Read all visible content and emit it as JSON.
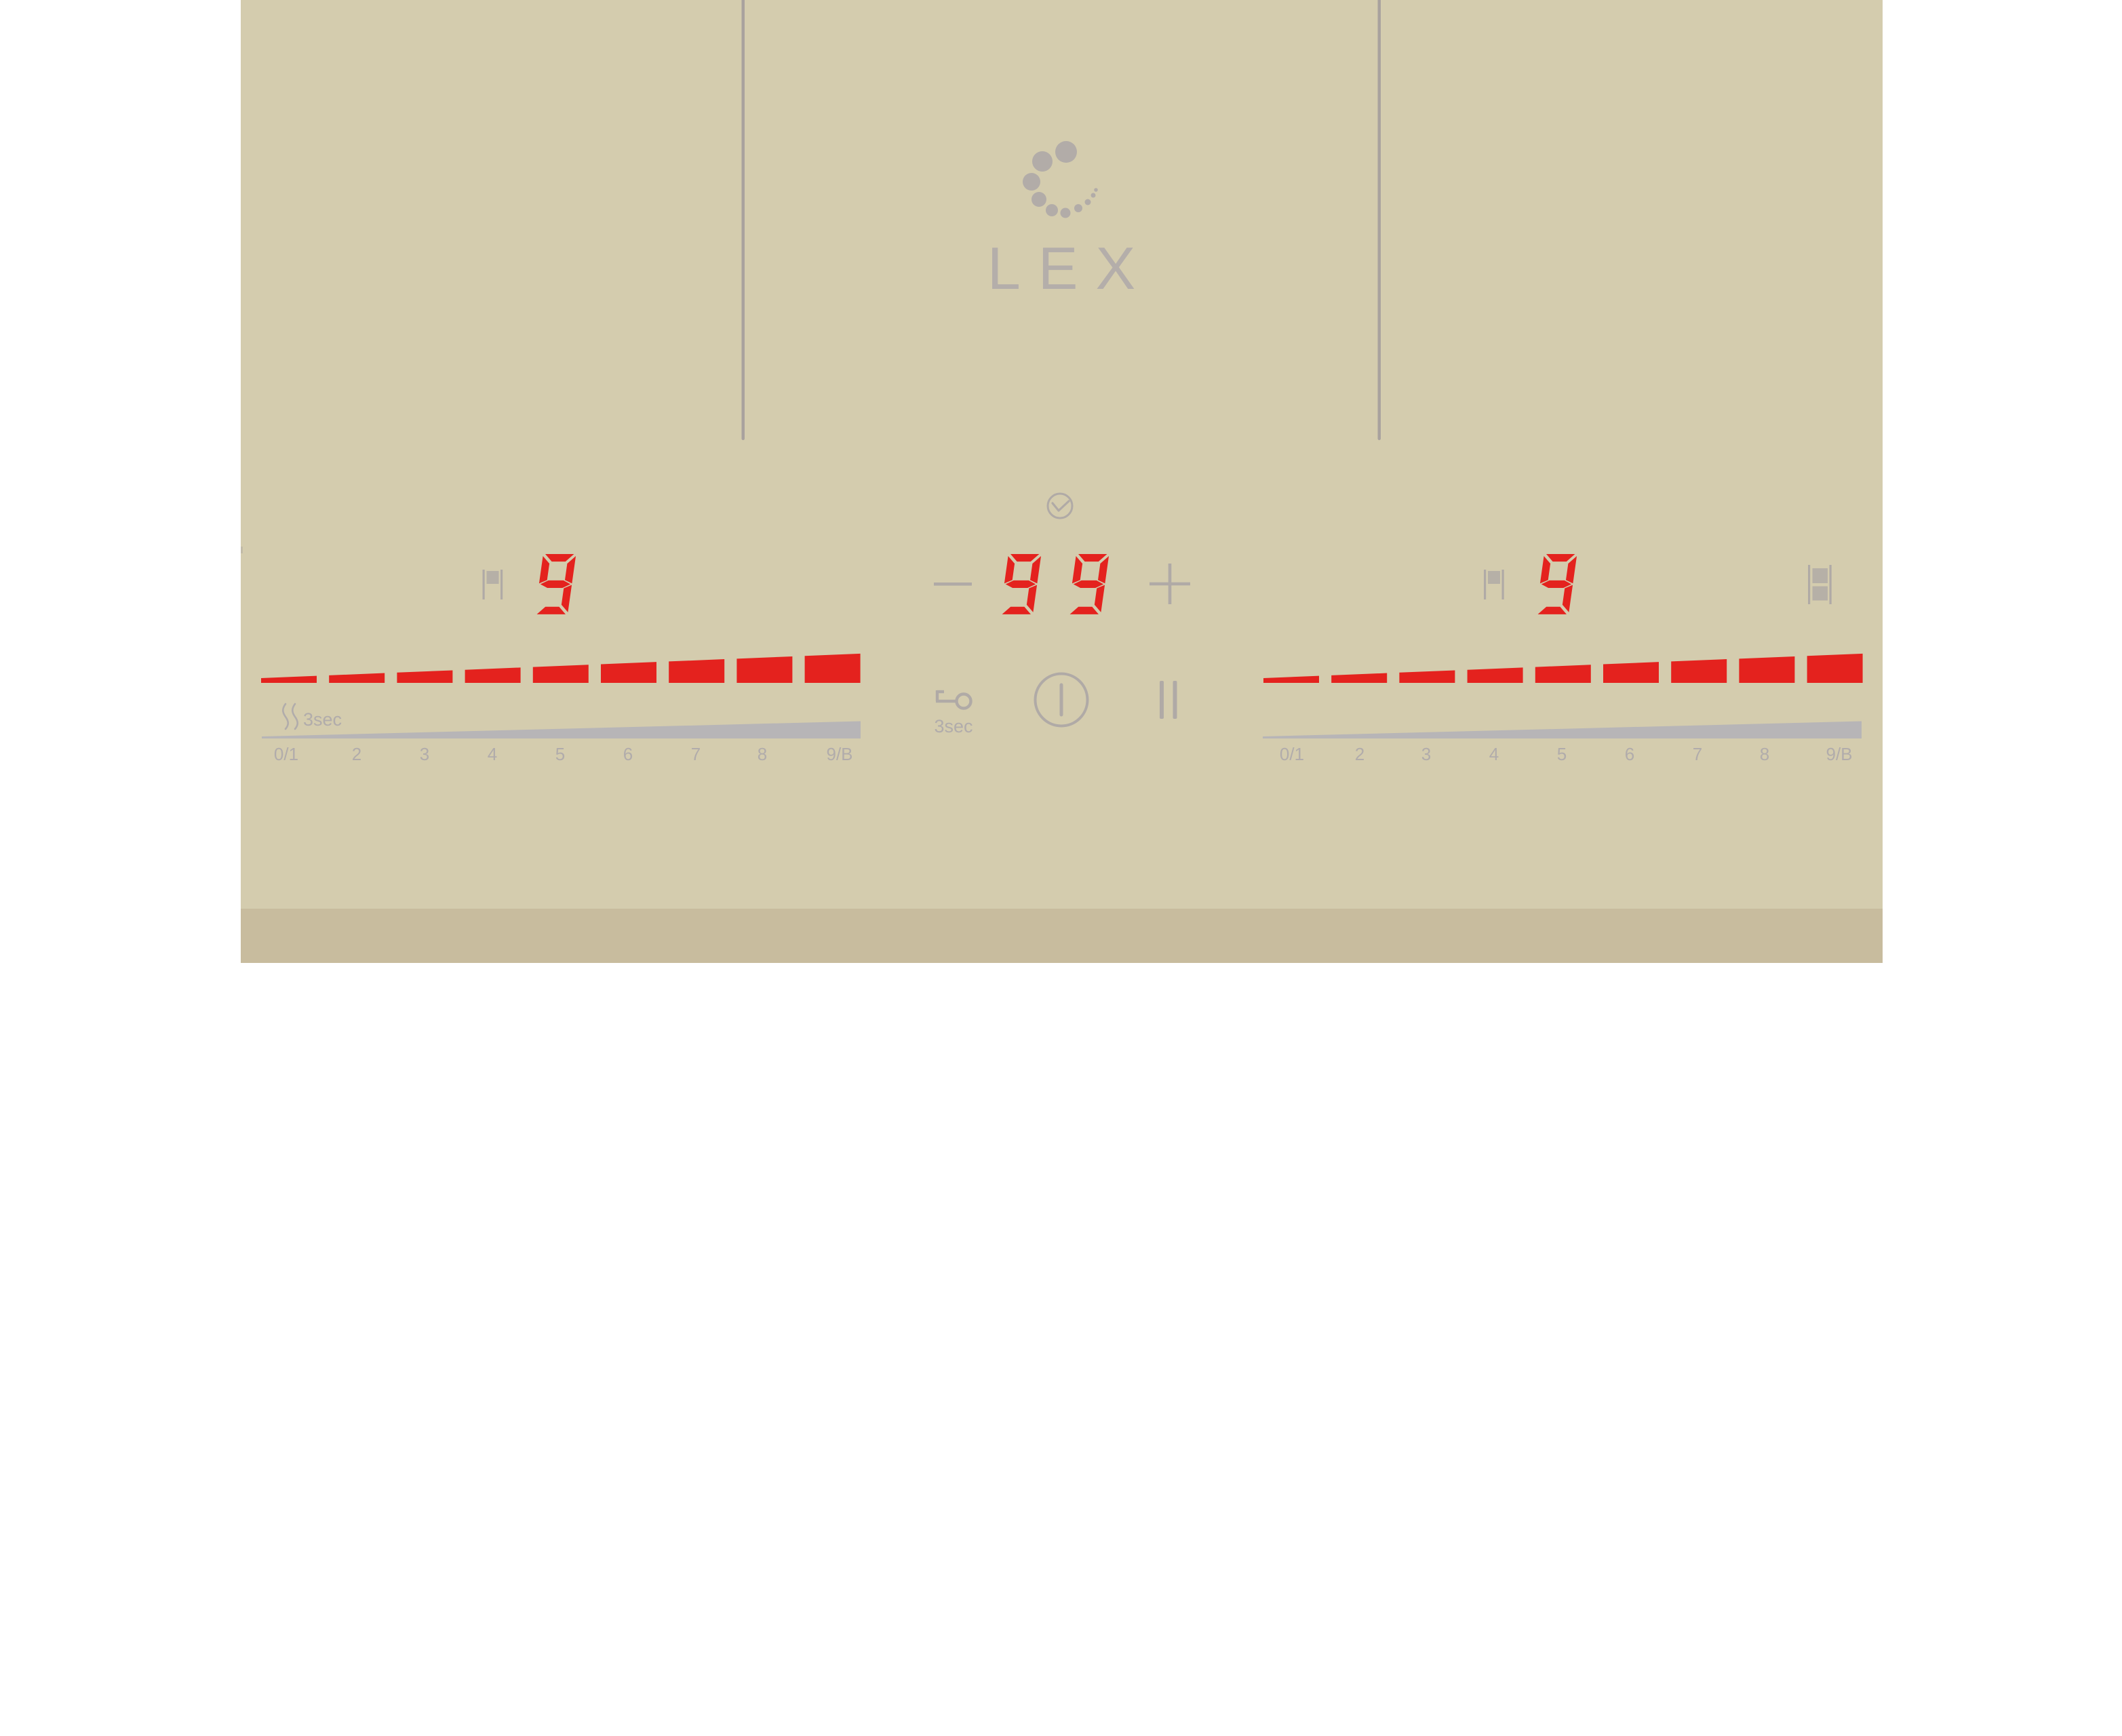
{
  "brand": {
    "logo_text": "LEX",
    "logo_icon": "dot-spiral-spinner-icon"
  },
  "colors": {
    "panel": "#d4ccae",
    "panel_edge": "#c8bc9e",
    "display_red": "#e4221e",
    "icon_gray": "#b0aaa6",
    "divider_gray": "#a9a29e",
    "slider_gray": "#b7b5b7",
    "label_gray": "#b1acab"
  },
  "timer": {
    "display_value": "99",
    "clock_icon": "timer-clock-icon",
    "minus_icon": "minus-icon",
    "plus_icon": "plus-icon"
  },
  "center": {
    "lock_icon": "key-lock-icon",
    "lock_hold_text": "3sec",
    "power_icon": "power-icon",
    "pause_icon": "pause-icon"
  },
  "left_zone": {
    "power_level": "9",
    "zone_select_icon": "zone-flag-icon",
    "heat_hold_text": "3sec",
    "residual_heat_icon": "heat-waves-icon",
    "segments_total": 9,
    "segments_lit": 9,
    "scale_labels": [
      "0/1",
      "2",
      "3",
      "4",
      "5",
      "6",
      "7",
      "8",
      "9/B"
    ]
  },
  "right_zone": {
    "power_level": "9",
    "zone_select_icon": "zone-flag-icon",
    "bridge_icon": "bridge-icon",
    "segments_total": 9,
    "segments_lit": 9,
    "scale_labels": [
      "0/1",
      "2",
      "3",
      "4",
      "5",
      "6",
      "7",
      "8",
      "9/B"
    ]
  }
}
